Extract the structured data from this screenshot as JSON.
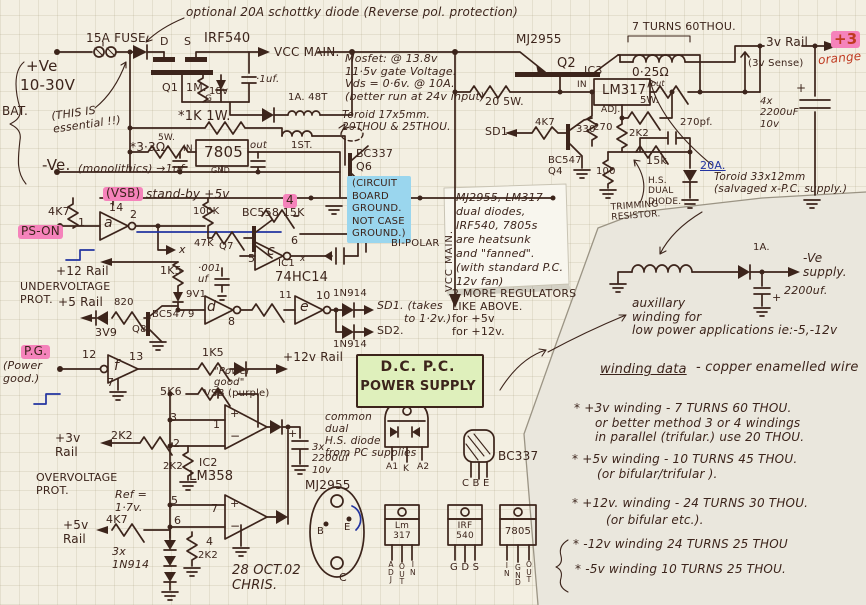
{
  "colors": {
    "ink": "#3c241b",
    "blue_ink": "#2334a0",
    "red_ink": "#bf3a20",
    "pink_highlight": "#f583bb",
    "blue_highlight": "#9ad6ee",
    "green_box": "#dff0bc",
    "paper": "#f3efe2",
    "overlay_note": "#eae7dd",
    "sticky_note": "#f8f6ee"
  },
  "labels": {
    "schottky_note": "optional 20A schottky diode (Reverse pol. protection)",
    "fuse": "15A FUSE.",
    "pin_d": "D",
    "pin_s": "S",
    "irf540": "IRF540",
    "vcc_main": "VCC MAIN.",
    "plus_ve": "+Ve",
    "volt_range": "10-30V",
    "bat": "BAT.",
    "essential": "(THIS IS\nessential !!)",
    "q1": "Q1",
    "r_1m": "1M.",
    "pin_g": "G",
    "z_18v": "18v",
    "c_01uf": "·1uf.",
    "coil_48t": "1A. 48T",
    "mosfet_note": "Mosfet: @ 13.8v\n11·5v gate Voltage.\nVds = 0·6v. @ 10A.\n(better run at 24v input)",
    "r_1k1w": "*1K 1W.",
    "toroid17": "Toroid 17x5mm.\n20THOU & 25THOU.",
    "r_3r3": "*3·3Ω",
    "r_3r3_w": "5W.",
    "in_7805": "IN",
    "ic_7805": "7805",
    "out_7805": "out",
    "gnd_7805": "GND",
    "monolithics": "(monolithics) →1uf",
    "minus_ve": "-Ve.",
    "first_winding": "1ST.",
    "bc337_q6": "BC337\nQ6",
    "r_1k_q6": "1k",
    "ground_note": "(CIRCUIT\nBOARD\nGROUND.\nNOT CASE\nGROUND.)",
    "pin4_hl": "4",
    "vsb_tag": "(VSB)",
    "standby": "stand-by +5v",
    "r_4k7_a": "4K7",
    "pin14": "14",
    "pin1": "1",
    "pin2": "2",
    "gate_a": "a",
    "ps_on": "PS-ON",
    "x_mark": "x",
    "r_100k": "100K",
    "bc558_15k": "BC558 15K",
    "r_47k": "47K",
    "q7": "Q7",
    "c_001": "·001\nuf",
    "pin5c": "5",
    "gate_c": "c",
    "pin6c": "6",
    "ic1": "IC1",
    "x_small": "x",
    "ic1_name": "74HC14",
    "bipolar": "BI-POLAR",
    "vcc_vert": "VCC MAIN.",
    "plus12_rail": "+12 Rail",
    "undervoltage": "UNDERVOLTAGE\nPROT.",
    "r_1k5_uv": "1K5",
    "z_9v1": "9V1",
    "plus5_rail": "+5 Rail",
    "r_820": "820",
    "bc547_q8": "BC547",
    "pin9": "9",
    "q8": "Q8",
    "z_3v9": "3V9",
    "gate_d": "d",
    "pin8": "8",
    "pin11": "11",
    "gate_e": "e",
    "pin10": "10",
    "d_1n914_a": "1N914",
    "d_1n914_b": "1N914",
    "sd1_note": "SD1. (takes",
    "sd1_note2": "to 1·2v.)",
    "sd2": "SD2.",
    "r_1k5_pg": "1K5",
    "pg_tag": "P.G.",
    "pg_sub": "(Power\ngood.)",
    "pin12": "12",
    "pin13": "13",
    "gate_f": "f",
    "pin7f": "7",
    "power_good_q": "\"Power\ngood\"",
    "plus12v_rail": "+12v Rail",
    "vsb_purple": "VSB (purple)",
    "r_5k6": "5K6",
    "pin3a": "3",
    "pin2a": "2",
    "pin1a": "1",
    "plus3v_rail": "+3v\nRail",
    "r_2k2_a": "2K2",
    "ic2": "IC2",
    "lm358": "LM358",
    "r_2k2_b": "2K2",
    "overvoltage": "OVERVOLTAGE\nPROT.",
    "ref_17": "Ref =\n1·7v.",
    "pin5b": "5",
    "pin6b": "6",
    "pin7b": "7",
    "pin4b": "4",
    "plus5v_rail2": "+5v\nRail",
    "r_4k7_b": "4K7",
    "d_3x": "3x\n1N914",
    "r_2k2_c": "2K2",
    "date_sig": "28 OCT.02\nCHRIS.",
    "cap_3x": "3x\n2200uf\n10v",
    "plus_1": "+",
    "minus_1": "−",
    "plus_2": "+",
    "minus_2": "−",
    "cap_plus1": "+",
    "cap_plus2": "+",
    "cap_plus3": "+",
    "common_note": "common\ndual\nH.S. diode\nfrom PC supplies",
    "pin_a1": "A1",
    "pin_k": "K",
    "pin_a2": "A2",
    "bc337_pkg": "BC337",
    "pins_cbe": "C  B  E",
    "mj2955_pkg": "MJ2955",
    "pin_b": "B",
    "pin_e": "E",
    "pin_c": "C",
    "lm317_pkg": "Lm\n317",
    "lm317_p1": "A\nD\nJ",
    "lm317_p2": "O\nU\nT",
    "lm317_p3": "I\nN",
    "irf540_pkg": "IRF\n540",
    "irf540_pins": "G   D   S",
    "sn7805_pkg": "7805",
    "sn7805_p1": "I\nN",
    "sn7805_p2": "G\nN\nD",
    "sn7805_p3": "O\nU\nT",
    "dc_title": "D.C.   P.C.",
    "dc_title2": "POWER SUPPLY",
    "mj2955_top": "MJ2955",
    "q2": "Q2",
    "r_20_5w": "20  5W.",
    "ic3": "IC3",
    "lm317_main": "LM317",
    "in_317": "IN",
    "out_317": "out",
    "adj_317": "ADJ.",
    "r_025": "0·25Ω",
    "r_025_w": "5W.",
    "turns7": "7 TURNS  60THOU.",
    "rail_3v": "3v Rail",
    "plus3_tag": "+3",
    "orange": "orange",
    "sense_3v": "(3v Sense)",
    "cap_4x": "4x\n2200uF\n10v",
    "sd1": "SD1",
    "r_4k7_c": "4K7",
    "r_330": "330",
    "r_2k2_d": "2K2",
    "r_270": "270",
    "c_270pf": "270pf.",
    "bc547_q4": "BC547\nQ4",
    "r_100": "100",
    "r_15k": "15k",
    "a_20": "20A.",
    "hs_dual": "H.S.\nDUAL\nDIODE.",
    "trimming": "TRIMMING\nRESISTOR.",
    "toroid33": "Toroid 33x12mm\n(salvaged x-P.C. supply.)",
    "sticky_note": "MJ2955, LM317\ndual diodes,\nIRF540, 7805s\nare heatsunk\nand \"fanned\".\n(with standard P.C.\n12v fan)",
    "two_more": "2 MORE REGULATORS\nLIKE ABOVE.\nfor  +5v\nfor  +12v.",
    "aux_note": "auxillary\nwinding for\nlow power applications  ie:-5,-12v",
    "d_1a": "1A.",
    "ve_supply": "-Ve\nsupply.",
    "c_2200": "2200uf.",
    "wind_title": "winding data",
    "wind_title2": "- copper enamelled wire",
    "w1": "* +3v winding  -  7 TURNS  60 THOU.",
    "w2": "or better method  3 or 4 windings",
    "w3": "in parallel (trifular.)  use 20 THOU.",
    "w4": "* +5v winding  -  10 TURNS  45 THOU.",
    "w5": "(or bifular/trifular ).",
    "w6": "* +12v. winding -  24 TURNS  30 THOU.",
    "w7": "(or bifular etc.).",
    "w8": "* -12v winding     24 TURNS  25 THOU",
    "w9": "* -5v winding     10 TURNS  25 THOU."
  }
}
